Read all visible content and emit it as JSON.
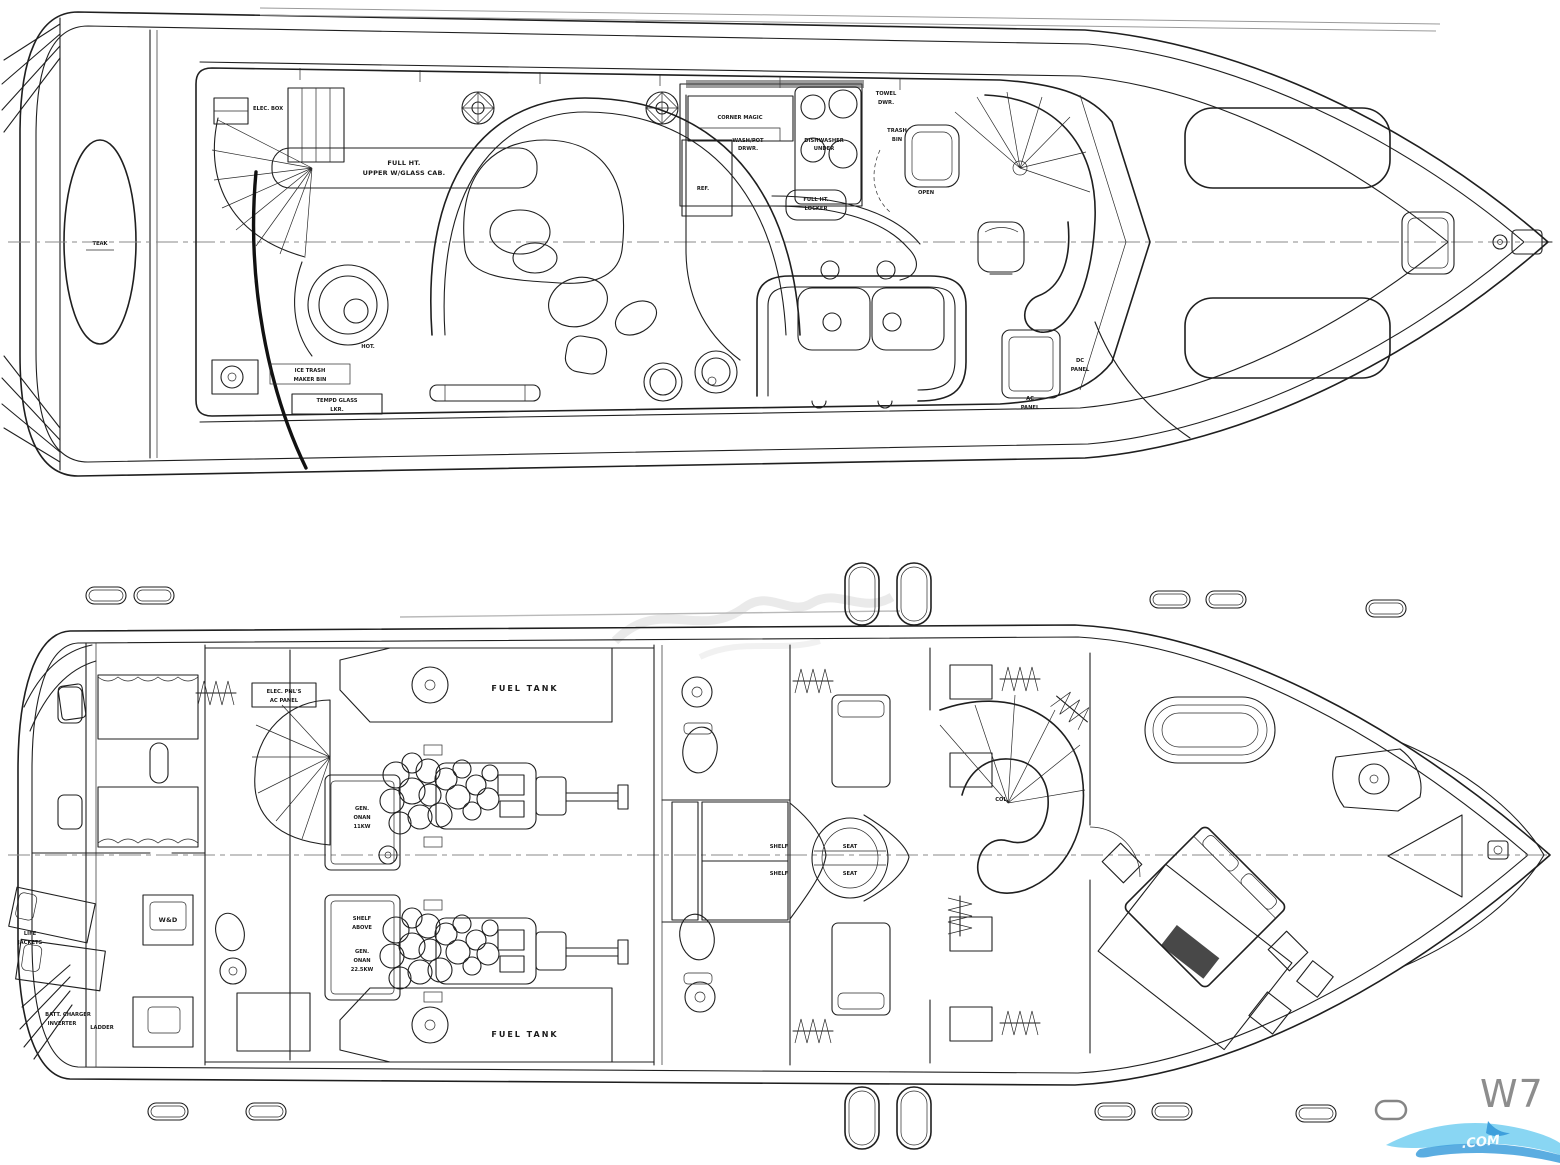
{
  "plans": {
    "main_deck": {
      "labels": {
        "teak": "TEAK",
        "elec_box": "ELEC. BOX",
        "full_ht_upper_l1": "FULL HT.",
        "full_ht_upper_l2": "UPPER W/GLASS CAB.",
        "corner_magic": "CORNER MAGIC",
        "washpot_l1": "WASH/POT",
        "washpot_l2": "DRWR.",
        "dishwasher_l1": "DISHWASHER",
        "dishwasher_l2": "UNDER",
        "towel_l1": "TOWEL",
        "towel_l2": "DWR.",
        "trash_l1": "TRASH",
        "trash_l2": "BIN",
        "ref": "REF.",
        "full_locker_l1": "FULL HT.",
        "full_locker_l2": "LOCKER",
        "open": "OPEN",
        "hot": "HOT.",
        "icemaker_l1": "ICE  TRASH",
        "icemaker_l2": "MAKER  BIN",
        "tempd_l1": "TEMPD GLASS",
        "tempd_l2": "LKR.",
        "dc_l1": "DC",
        "dc_l2": "PANEL",
        "ac_l1": "AC",
        "ac_l2": "PANEL"
      }
    },
    "lower_deck": {
      "labels": {
        "elec_pnls_l1": "ELEC. PNL'S",
        "elec_pnls_l2": "AC PANEL",
        "fuel_tank_fwd": "FUEL TANK",
        "fuel_tank_aft": "FUEL TANK",
        "gen1_l1": "GEN.",
        "gen1_l2": "ONAN",
        "gen1_l3": "11KW",
        "shelf_above_l1": "SHELF",
        "shelf_above_l2": "ABOVE",
        "gen2_l1": "GEN.",
        "gen2_l2": "ONAN",
        "gen2_l3": "22.5KW",
        "shelf_upper": "SHELF",
        "shelf_lower": "SHELF",
        "seat_upper": "SEAT",
        "seat_lower": "SEAT",
        "wd": "W&D",
        "life_jackets_l1": "LIFE",
        "life_jackets_l2": "JACKETS",
        "batt_l1": "BATT. CHARGER",
        "batt_l2": "INVERTER",
        "ladder": "LADDER",
        "col": "COL."
      }
    },
    "watermark": {
      "plan_code": "W7",
      "site": ".COM",
      "accent_light": "#7cd2f2",
      "accent_dark": "#3e9fdc"
    }
  }
}
